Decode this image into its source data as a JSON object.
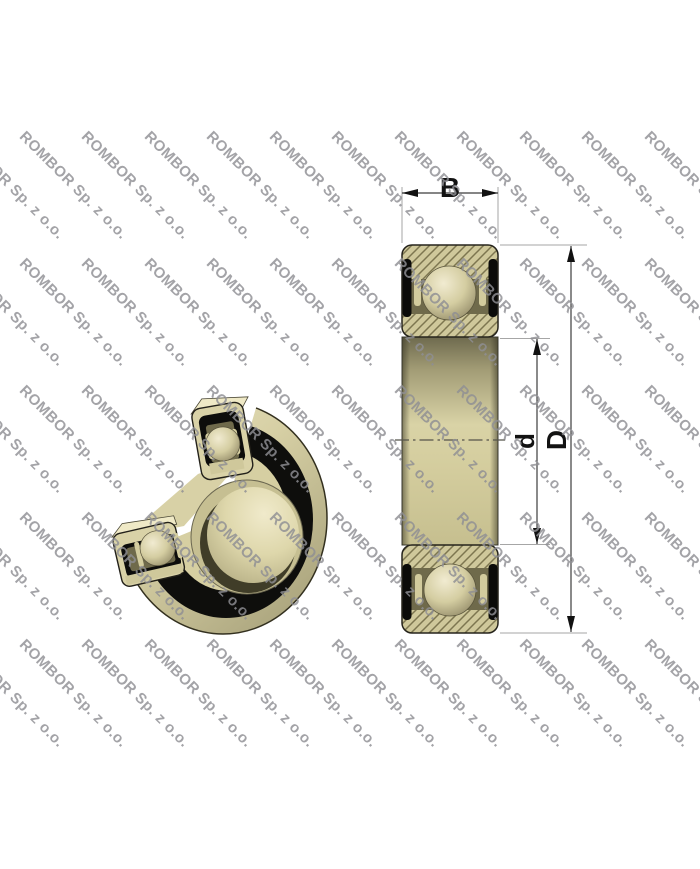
{
  "watermark": {
    "text": "ROMBOR Sp. z o.o."
  },
  "drawing": {
    "dimension_labels": {
      "width": "B",
      "outer_diameter": "D",
      "bore_diameter": "d"
    }
  },
  "palette": {
    "body_cream": "#d9d2a7",
    "hatch_tan": "#cfc89b",
    "hatch_line_olive": "#7d7650",
    "raceway_olive": "#6f6a4b",
    "seal_black": "#0d0d0b",
    "dimension_line": "#3c3c3c",
    "extension_line": "#a6a6a6",
    "watermark_gray": "#8f8f94",
    "background": "#ffffff"
  }
}
